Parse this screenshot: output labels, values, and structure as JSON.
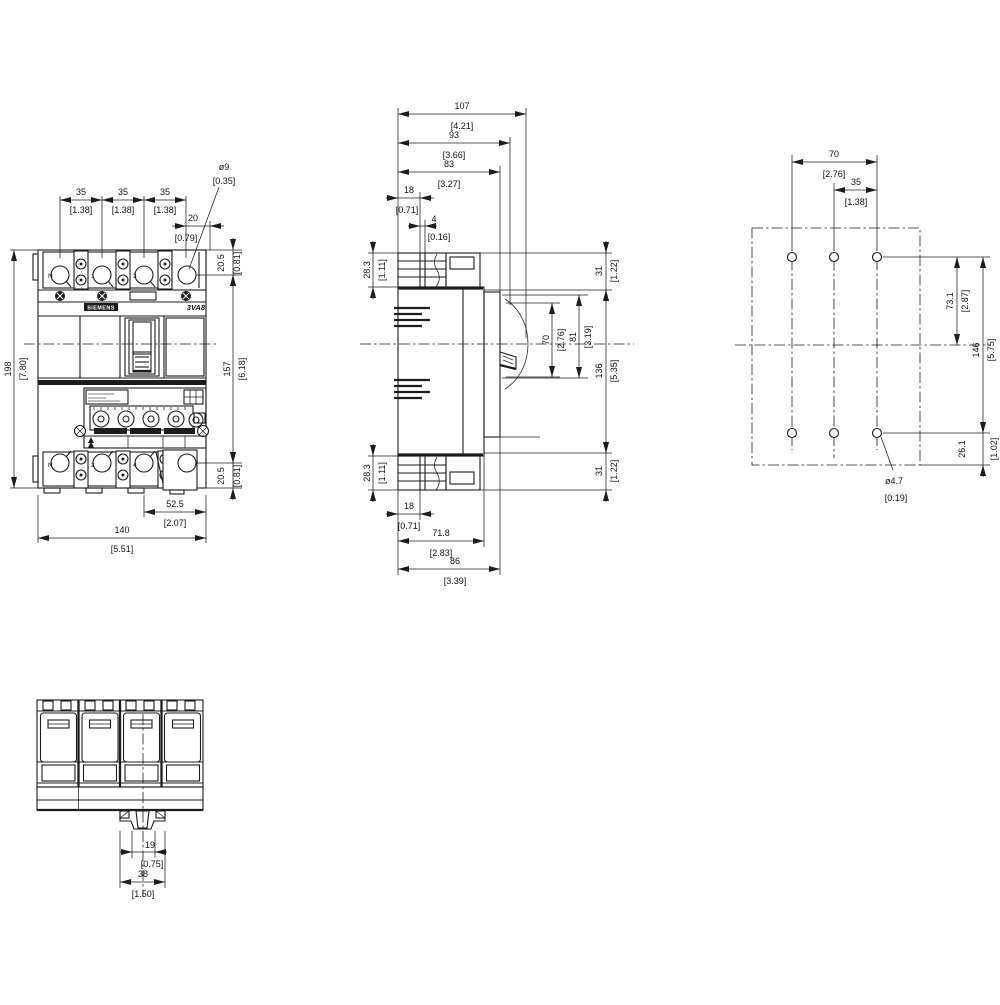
{
  "front": {
    "brand_label": "SIEMENS",
    "model_label": "3VA8",
    "terminal_labels_top": [
      "N",
      "1",
      "3"
    ],
    "terminal_labels_bottom": [
      "N",
      "2",
      "4"
    ],
    "dims": {
      "pitch_a": {
        "mm": "35",
        "inch": "[1.38]"
      },
      "pitch_b": {
        "mm": "35",
        "inch": "[1.38]"
      },
      "pitch_c": {
        "mm": "35",
        "inch": "[1.38]"
      },
      "edge_20": {
        "mm": "20",
        "inch": "[0.79]"
      },
      "hole_dia": {
        "mm": "ø9",
        "inch": "[0.35]"
      },
      "height": {
        "mm": "198",
        "inch": "[7.80]"
      },
      "hole_top": {
        "mm": "20.5",
        "inch": "[0.81]"
      },
      "hole_span": {
        "mm": "157",
        "inch": "[6.18]"
      },
      "hole_bottom": {
        "mm": "20.5",
        "inch": "[0.81]"
      },
      "width_partial": {
        "mm": "52.5",
        "inch": "[2.07]"
      },
      "width": {
        "mm": "140",
        "inch": "[5.51]"
      }
    }
  },
  "side": {
    "dims": {
      "depth_107": {
        "mm": "107",
        "inch": "[4.21]"
      },
      "depth_93": {
        "mm": "93",
        "inch": "[3.66]"
      },
      "depth_83": {
        "mm": "83",
        "inch": "[3.27]"
      },
      "top_18": {
        "mm": "18",
        "inch": "[0.71]"
      },
      "gap_4": {
        "mm": "4",
        "inch": "[0.16]"
      },
      "term_top": {
        "mm": "28.3",
        "inch": "[1.11]"
      },
      "term_bottom": {
        "mm": "28.3",
        "inch": "[1.11]"
      },
      "bottom_18": {
        "mm": "18",
        "inch": "[0.71]"
      },
      "depth_71_8": {
        "mm": "71.8",
        "inch": "[2.83]"
      },
      "depth_86": {
        "mm": "86",
        "inch": "[3.39]"
      },
      "top_31": {
        "mm": "31",
        "inch": "[1.22]"
      },
      "handle_70": {
        "mm": "70",
        "inch": "[2.76]"
      },
      "handle_81": {
        "mm": "81",
        "inch": "[3.19]"
      },
      "mid_136": {
        "mm": "136",
        "inch": "[5.35]"
      },
      "bottom_31": {
        "mm": "31",
        "inch": "[1.22]"
      }
    }
  },
  "rear": {
    "dims": {
      "holes_70": {
        "mm": "70",
        "inch": "[2.76]"
      },
      "holes_35": {
        "mm": "35",
        "inch": "[1.38]"
      },
      "upper_73_1": {
        "mm": "73.1",
        "inch": "[2.87]"
      },
      "span_146": {
        "mm": "146",
        "inch": "[5.75]"
      },
      "lower_26_1": {
        "mm": "26.1",
        "inch": "[1.02]"
      },
      "hole_dia": {
        "mm": "ø4.7",
        "inch": "[0.19]"
      }
    }
  },
  "bottom_view": {
    "dims": {
      "clip_19": {
        "mm": "19",
        "inch": "[0.75]"
      },
      "clip_38": {
        "mm": "38",
        "inch": "[1.50]"
      }
    }
  }
}
